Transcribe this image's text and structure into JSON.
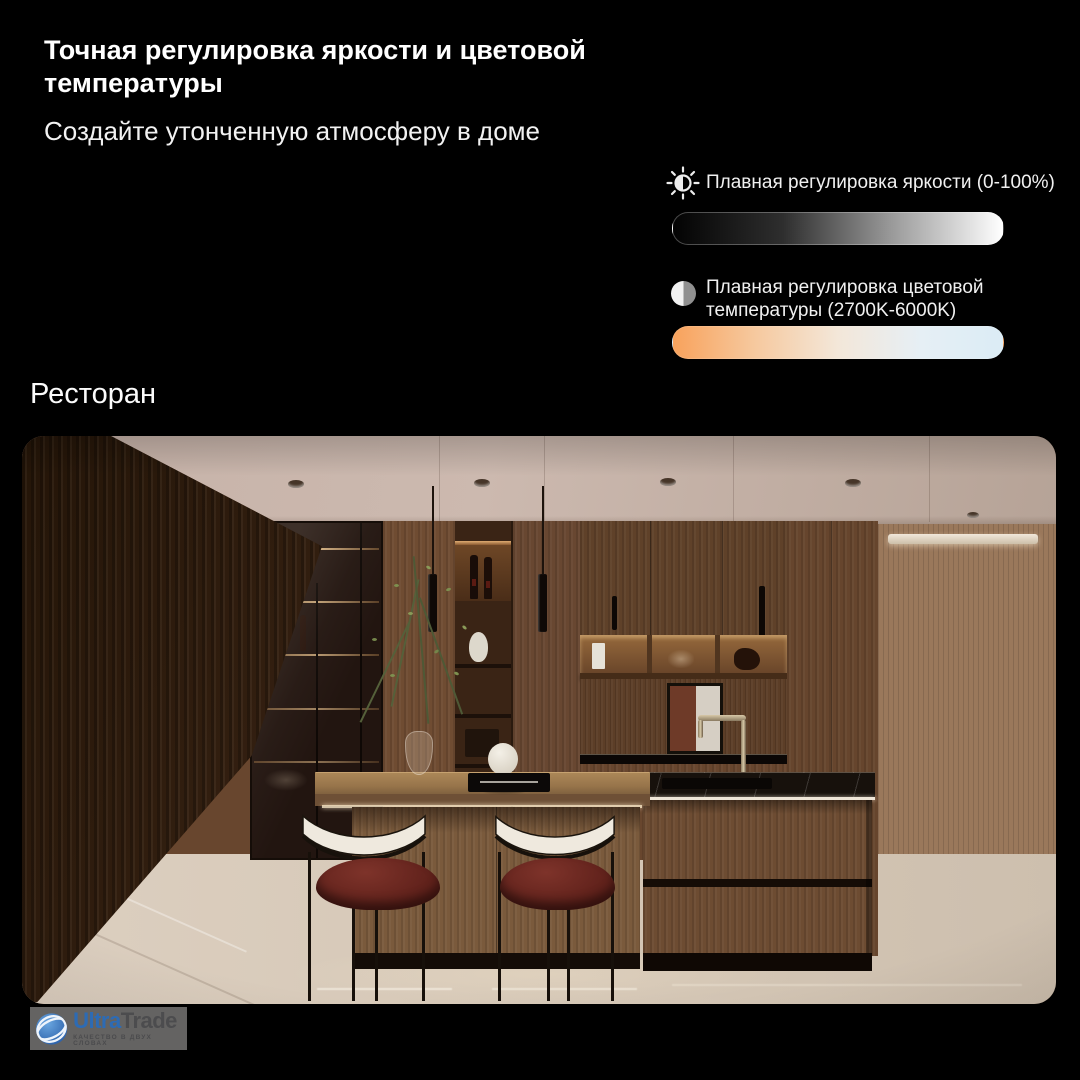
{
  "canvas": {
    "width": 1080,
    "height": 1080,
    "background": "#000000"
  },
  "header": {
    "title": "Точная регулировка яркости и цветовой температуры",
    "subtitle": "Создайте утонченную атмосферу в доме"
  },
  "features": [
    {
      "icon": "brightness-icon",
      "label": "Плавная регулировка яркости (0-100%)",
      "gradient": [
        "#030303",
        "#2e2e2e",
        "#9b9b9b",
        "#ffffff"
      ]
    },
    {
      "icon": "contrast-icon",
      "label": "Плавная регулировка цветовой температуры (2700K-6000K)",
      "gradient": [
        "#f8a25c",
        "#f6c99f",
        "#f3e7d9",
        "#e6eff5",
        "#dbecf5"
      ]
    }
  ],
  "scene": {
    "label": "Ресторан"
  },
  "logo": {
    "brand_primary": "Ultra",
    "brand_secondary": "Trade",
    "tagline": "КАЧЕСТВО В ДВУХ СЛОВАХ",
    "accent": "#2e6cb6"
  },
  "colors": {
    "text_primary": "#ffffff",
    "text_secondary": "#f2f2f2",
    "track_border": "rgba(255,255,255,0.28)"
  }
}
